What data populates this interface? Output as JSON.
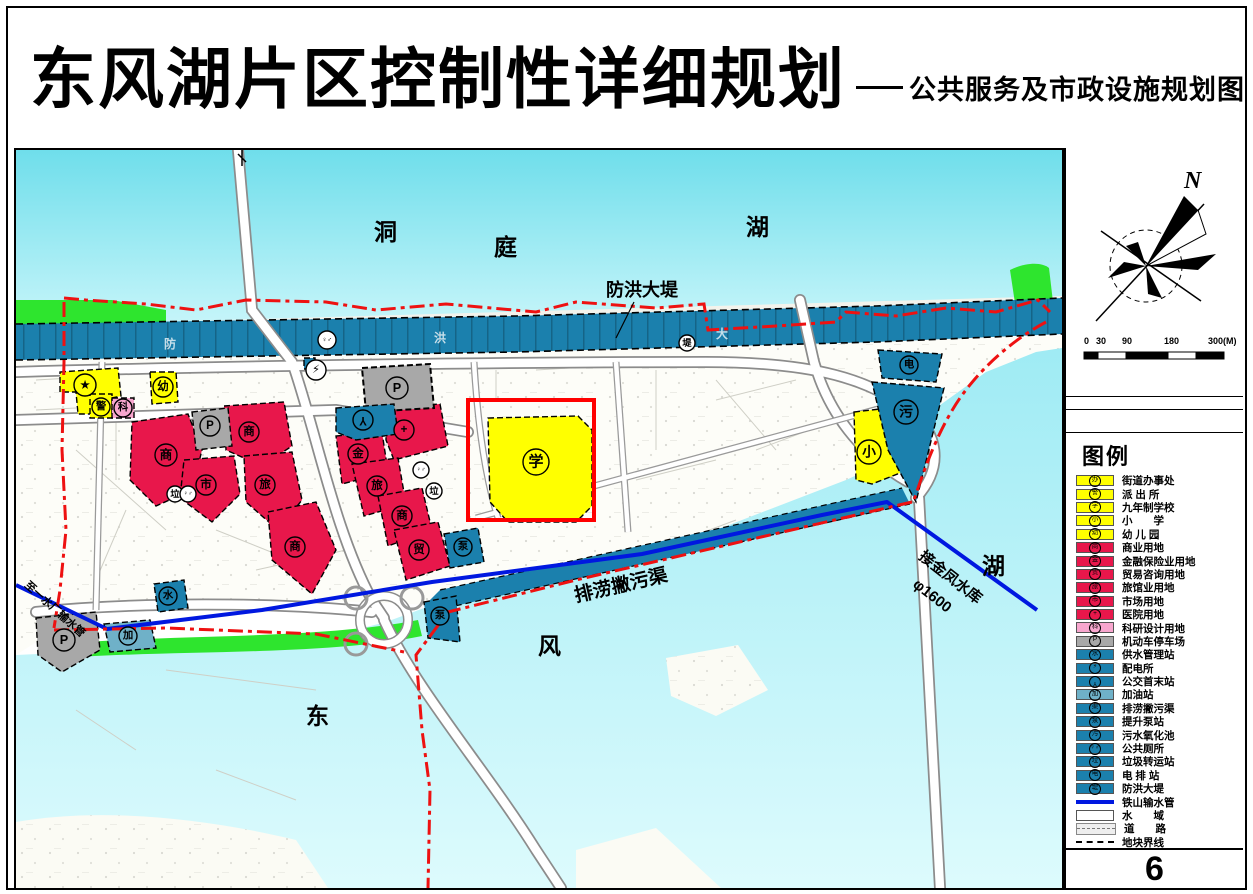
{
  "title": {
    "main": "东风湖片区控制性详细规划",
    "subtitle": "公共服务及市政设施规划图"
  },
  "page_number": "6",
  "compass": {
    "north_label": "N"
  },
  "scale_bar": {
    "ticks": [
      "0",
      "30",
      "90",
      "180",
      "300(M)"
    ]
  },
  "colors": {
    "yellow": "#ffff00",
    "red": "#e8174b",
    "pink": "#f8a6ce",
    "gray": "#a8a8a8",
    "blue": "#1b80ad",
    "lightblue": "#6fb1c8",
    "green": "#2ee52e",
    "pipe": "#0018e0",
    "boundary": "#ee1111",
    "water": "#8de9f3"
  },
  "legend": {
    "title": "图例",
    "items": [
      {
        "kind": "icon",
        "symbol": "办",
        "type": "yellow",
        "label": "街道办事处"
      },
      {
        "kind": "icon",
        "symbol": "警",
        "type": "yellow",
        "label": "派 出 所"
      },
      {
        "kind": "icon",
        "symbol": "学",
        "type": "yellow",
        "label": "九年制学校"
      },
      {
        "kind": "icon",
        "symbol": "小",
        "type": "yellow",
        "label": "小　　学"
      },
      {
        "kind": "icon",
        "symbol": "幼",
        "type": "yellow",
        "label": "幼 儿 园"
      },
      {
        "kind": "icon",
        "symbol": "商",
        "type": "red",
        "label": "商业用地"
      },
      {
        "kind": "icon",
        "symbol": "金",
        "type": "red",
        "label": "金融保险业用地"
      },
      {
        "kind": "icon",
        "symbol": "贸",
        "type": "red",
        "label": "贸易咨询用地"
      },
      {
        "kind": "icon",
        "symbol": "旅",
        "type": "red",
        "label": "旅馆业用地"
      },
      {
        "kind": "icon",
        "symbol": "市",
        "type": "red",
        "label": "市场用地"
      },
      {
        "kind": "icon",
        "symbol": "+",
        "type": "red",
        "label": "医院用地"
      },
      {
        "kind": "icon",
        "symbol": "科",
        "type": "pink",
        "label": "科研设计用地"
      },
      {
        "kind": "icon",
        "symbol": "P",
        "type": "gray",
        "label": "机动车停车场"
      },
      {
        "kind": "icon",
        "symbol": "水",
        "type": "blue",
        "label": "供水管理站"
      },
      {
        "kind": "icon",
        "symbol": "⚡",
        "type": "blue",
        "label": "配电所"
      },
      {
        "kind": "icon",
        "symbol": "Y",
        "rot": true,
        "type": "blue",
        "label": "公交首末站"
      },
      {
        "kind": "icon",
        "symbol": "加",
        "type": "lightblue",
        "label": "加油站"
      },
      {
        "kind": "icon",
        "symbol": "渠",
        "type": "blue",
        "label": "排涝撇污渠"
      },
      {
        "kind": "icon",
        "symbol": "泵",
        "type": "blue",
        "label": "提升泵站"
      },
      {
        "kind": "icon",
        "symbol": "污",
        "type": "blue",
        "label": "污水氧化池"
      },
      {
        "kind": "icon",
        "symbol": "♀♂",
        "type": "blue",
        "label": "公共厕所"
      },
      {
        "kind": "icon",
        "symbol": "垃",
        "type": "blue",
        "label": "垃圾转运站"
      },
      {
        "kind": "icon",
        "symbol": "电",
        "type": "blue",
        "label": "电 排 站"
      },
      {
        "kind": "icon",
        "symbol": "堤",
        "type": "blue",
        "label": "防洪大堤"
      },
      {
        "kind": "blue-line",
        "label": "铁山输水管"
      },
      {
        "kind": "white-box",
        "label": "水　　域"
      },
      {
        "kind": "road",
        "label": "道　　路"
      },
      {
        "kind": "black-dash",
        "label": "地块界线"
      },
      {
        "kind": "red-dashdot",
        "label": "规划界线"
      }
    ]
  },
  "map": {
    "labels": [
      {
        "text": "洞",
        "x": 358,
        "y": 90,
        "size": 23,
        "rot": 0
      },
      {
        "text": "庭",
        "x": 478,
        "y": 105,
        "size": 23,
        "rot": 0
      },
      {
        "text": "湖",
        "x": 730,
        "y": 85,
        "size": 23,
        "rot": 0
      },
      {
        "text": "防洪大堤",
        "x": 590,
        "y": 146,
        "size": 18,
        "rot": 0
      },
      {
        "text": "排涝撇污渠",
        "x": 560,
        "y": 452,
        "size": 19,
        "rot": -13
      },
      {
        "text": "东",
        "x": 290,
        "y": 574,
        "size": 23,
        "rot": 0
      },
      {
        "text": "风",
        "x": 522,
        "y": 504,
        "size": 23,
        "rot": 0
      },
      {
        "text": "湖",
        "x": 966,
        "y": 424,
        "size": 23,
        "rot": 0
      },
      {
        "text": "接金凤水库",
        "x": 902,
        "y": 408,
        "size": 15,
        "rot": 38
      },
      {
        "text": "φ1600",
        "x": 896,
        "y": 436,
        "size": 15,
        "rot": 38
      },
      {
        "text": "至一水厂输水管",
        "x": 8,
        "y": 436,
        "size": 11,
        "rot": 42
      },
      {
        "text": "防",
        "x": 148,
        "y": 198,
        "size": 12,
        "rot": 0,
        "faint": true
      },
      {
        "text": "洪",
        "x": 418,
        "y": 192,
        "size": 12,
        "rot": 0,
        "faint": true
      },
      {
        "text": "大",
        "x": 700,
        "y": 188,
        "size": 12,
        "rot": 0,
        "faint": true
      }
    ],
    "markers": [
      {
        "char": "★",
        "type": "yellow",
        "x": 69,
        "y": 235,
        "r": 11
      },
      {
        "char": "警",
        "type": "yellow",
        "x": 85,
        "y": 257,
        "r": 9
      },
      {
        "char": "科",
        "type": "pink",
        "x": 107,
        "y": 258,
        "r": 9
      },
      {
        "char": "幼",
        "type": "yellow",
        "x": 147,
        "y": 237,
        "r": 10
      },
      {
        "char": "学",
        "type": "yellow",
        "x": 520,
        "y": 312,
        "r": 13
      },
      {
        "char": "小",
        "type": "yellow",
        "x": 853,
        "y": 302,
        "r": 12
      },
      {
        "char": "商",
        "type": "red",
        "x": 150,
        "y": 305,
        "r": 11
      },
      {
        "char": "商",
        "type": "red",
        "x": 233,
        "y": 282,
        "r": 10
      },
      {
        "char": "市",
        "type": "red",
        "x": 190,
        "y": 335,
        "r": 10
      },
      {
        "char": "旅",
        "type": "red",
        "x": 249,
        "y": 335,
        "r": 10
      },
      {
        "char": "商",
        "type": "red",
        "x": 279,
        "y": 397,
        "r": 10
      },
      {
        "char": "金",
        "type": "red",
        "x": 342,
        "y": 304,
        "r": 10
      },
      {
        "char": "+",
        "type": "red",
        "x": 388,
        "y": 280,
        "r": 10
      },
      {
        "char": "旅",
        "type": "red",
        "x": 361,
        "y": 336,
        "r": 10
      },
      {
        "char": "商",
        "type": "red",
        "x": 386,
        "y": 366,
        "r": 10
      },
      {
        "char": "贸",
        "type": "red",
        "x": 403,
        "y": 400,
        "r": 10
      },
      {
        "char": "P",
        "type": "gray",
        "x": 194,
        "y": 276,
        "r": 10
      },
      {
        "char": "P",
        "type": "gray",
        "x": 381,
        "y": 238,
        "r": 11
      },
      {
        "char": "P",
        "type": "gray",
        "x": 48,
        "y": 490,
        "r": 11
      },
      {
        "char": "水",
        "type": "blue",
        "x": 152,
        "y": 446,
        "r": 9
      },
      {
        "char": "加",
        "type": "lightblue",
        "x": 112,
        "y": 486,
        "r": 9
      },
      {
        "char": "Y",
        "rot": true,
        "type": "blue",
        "x": 347,
        "y": 270,
        "r": 10
      },
      {
        "char": "泵",
        "type": "blue",
        "x": 447,
        "y": 397,
        "r": 9
      },
      {
        "char": "泵",
        "type": "blue",
        "x": 424,
        "y": 466,
        "r": 9
      },
      {
        "char": "污",
        "type": "blue",
        "x": 890,
        "y": 262,
        "r": 12
      },
      {
        "char": "电",
        "type": "blue",
        "x": 893,
        "y": 215,
        "r": 9
      },
      {
        "char": "⚡",
        "type": "white",
        "x": 300,
        "y": 220,
        "r": 10
      },
      {
        "char": "♀♂",
        "type": "white",
        "x": 311,
        "y": 190,
        "r": 9
      },
      {
        "char": "垃",
        "type": "white",
        "x": 159,
        "y": 344,
        "r": 8
      },
      {
        "char": "♀♂",
        "type": "white",
        "x": 172,
        "y": 344,
        "r": 8
      },
      {
        "char": "♀♂",
        "type": "white",
        "x": 405,
        "y": 320,
        "r": 8
      },
      {
        "char": "垃",
        "type": "white",
        "x": 418,
        "y": 341,
        "r": 8
      },
      {
        "char": "堤",
        "type": "white",
        "x": 671,
        "y": 193,
        "r": 8
      }
    ]
  }
}
